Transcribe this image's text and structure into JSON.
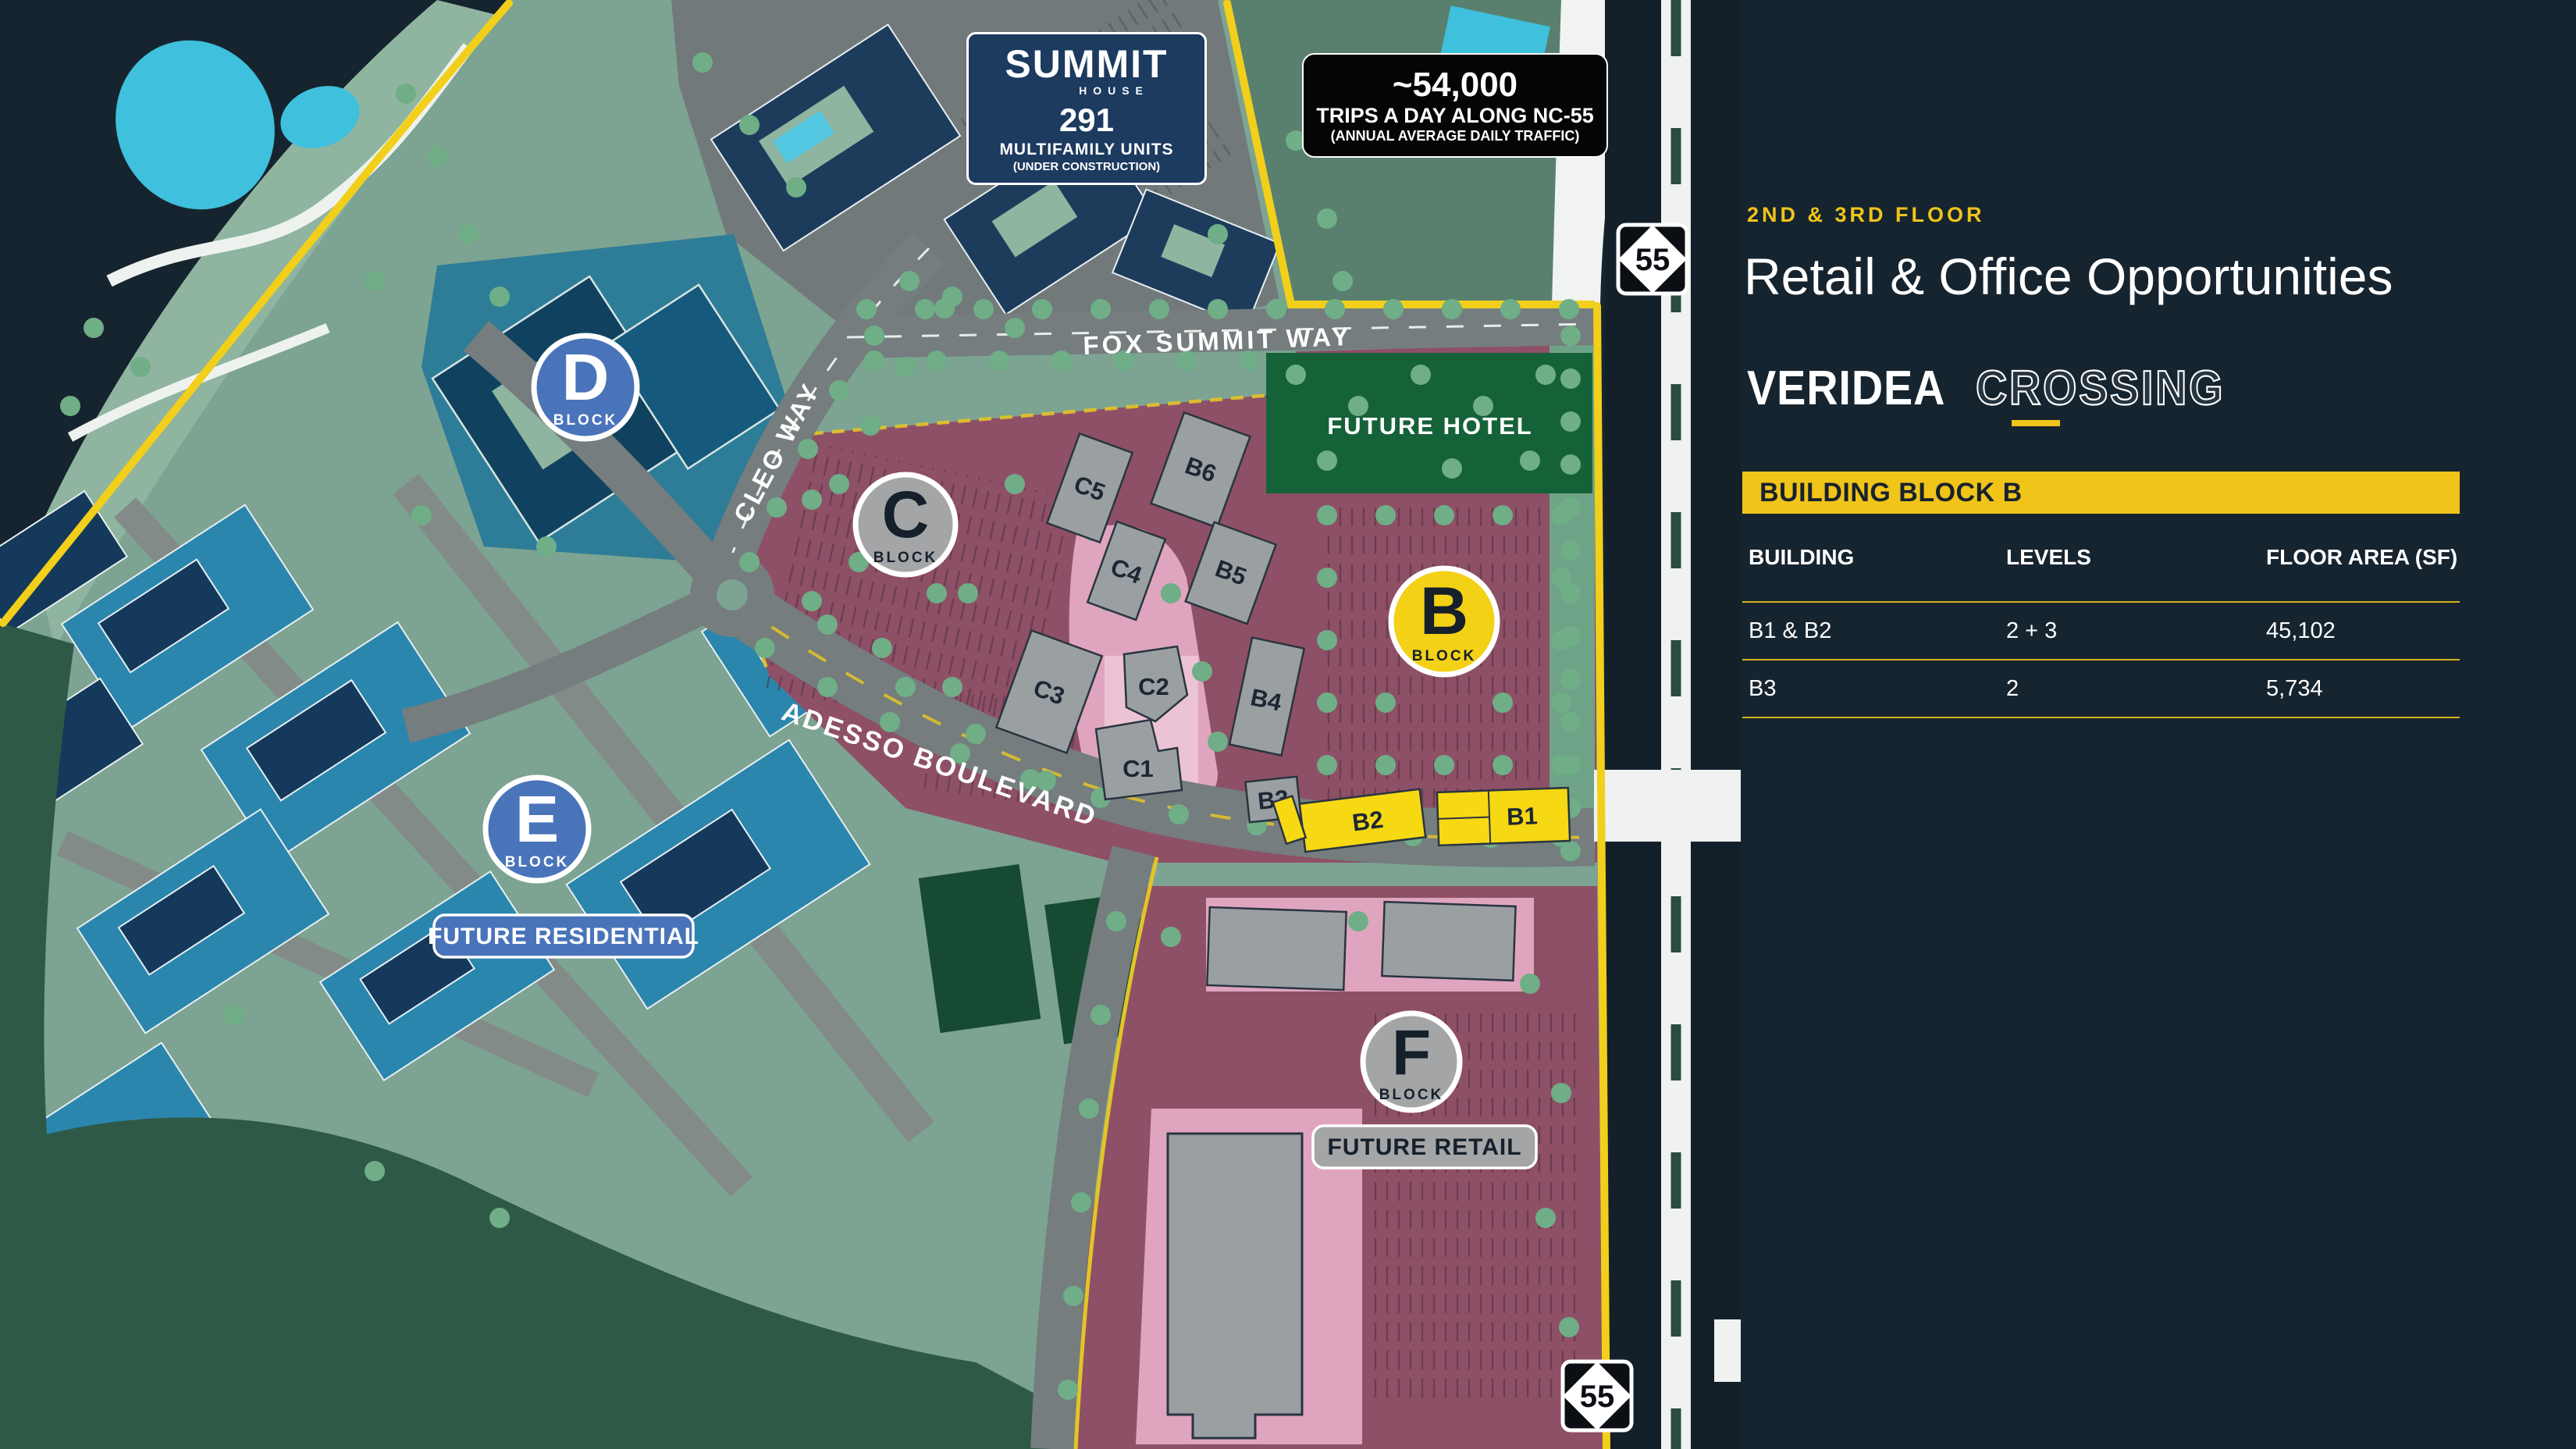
{
  "panel": {
    "floor_label": "2ND & 3RD FLOOR",
    "title": "Retail & Office Opportunities",
    "brand": {
      "solid": "VERIDEA",
      "outline": "CROSSING"
    },
    "table": {
      "header": "BUILDING BLOCK B",
      "columns": [
        "BUILDING",
        "LEVELS",
        "FLOOR AREA (SF)"
      ],
      "rows": [
        [
          "B1 & B2",
          "2 + 3",
          "45,102"
        ],
        [
          "B3",
          "2",
          "5,734"
        ]
      ]
    }
  },
  "signs": {
    "summit": {
      "line1": "SUMMIT",
      "line2": "HOUSE",
      "units": "291",
      "units_label": "MULTIFAMILY UNITS",
      "status": "(UNDER CONSTRUCTION)"
    },
    "traffic": {
      "count": "~54,000",
      "line2": "TRIPS A DAY ALONG NC-55",
      "line3": "(ANNUAL AVERAGE DAILY TRAFFIC)"
    }
  },
  "map": {
    "road_labels": {
      "fox_summit_way": "FOX SUMMIT WAY",
      "cleo_way": "CLEO WAY",
      "adesso_boulevard": "ADESSO BOULEVARD"
    },
    "area_labels": {
      "future_hotel": "FUTURE HOTEL",
      "future_residential": "FUTURE RESIDENTIAL",
      "future_retail": "FUTURE RETAIL"
    },
    "block_markers": {
      "d": {
        "letter": "D",
        "sub": "BLOCK"
      },
      "c": {
        "letter": "C",
        "sub": "BLOCK"
      },
      "b": {
        "letter": "B",
        "sub": "BLOCK"
      },
      "e": {
        "letter": "E",
        "sub": "BLOCK"
      },
      "f": {
        "letter": "F",
        "sub": "BLOCK"
      }
    },
    "building_labels": {
      "c5": "C5",
      "c4": "C4",
      "c3": "C3",
      "c2": "C2",
      "c1": "C1",
      "b6": "B6",
      "b5": "B5",
      "b4": "B4",
      "b3": "B3",
      "b2": "B2",
      "b1": "B1"
    },
    "highway_shield": "55"
  },
  "colors": {
    "accent_yellow": "#F0C419",
    "boundary_yellow": "#F2CF1A",
    "background_navy": "#16242F",
    "map_sage": "#7DA392",
    "map_maroon": "#8E5066",
    "walkway_pink": "#DFA5BF",
    "blue_building": "#2A86AD",
    "navy_building": "#1D3C5C",
    "block_blue": "#4A74BA",
    "block_gray": "#A3A5A7",
    "block_yellow": "#F2D116",
    "hotel_green": "#156238",
    "forest_green": "#2E5947",
    "pond_cyan": "#3FC0DC",
    "tree_green": "#6FAE87",
    "road_gray": "#757D7E"
  }
}
